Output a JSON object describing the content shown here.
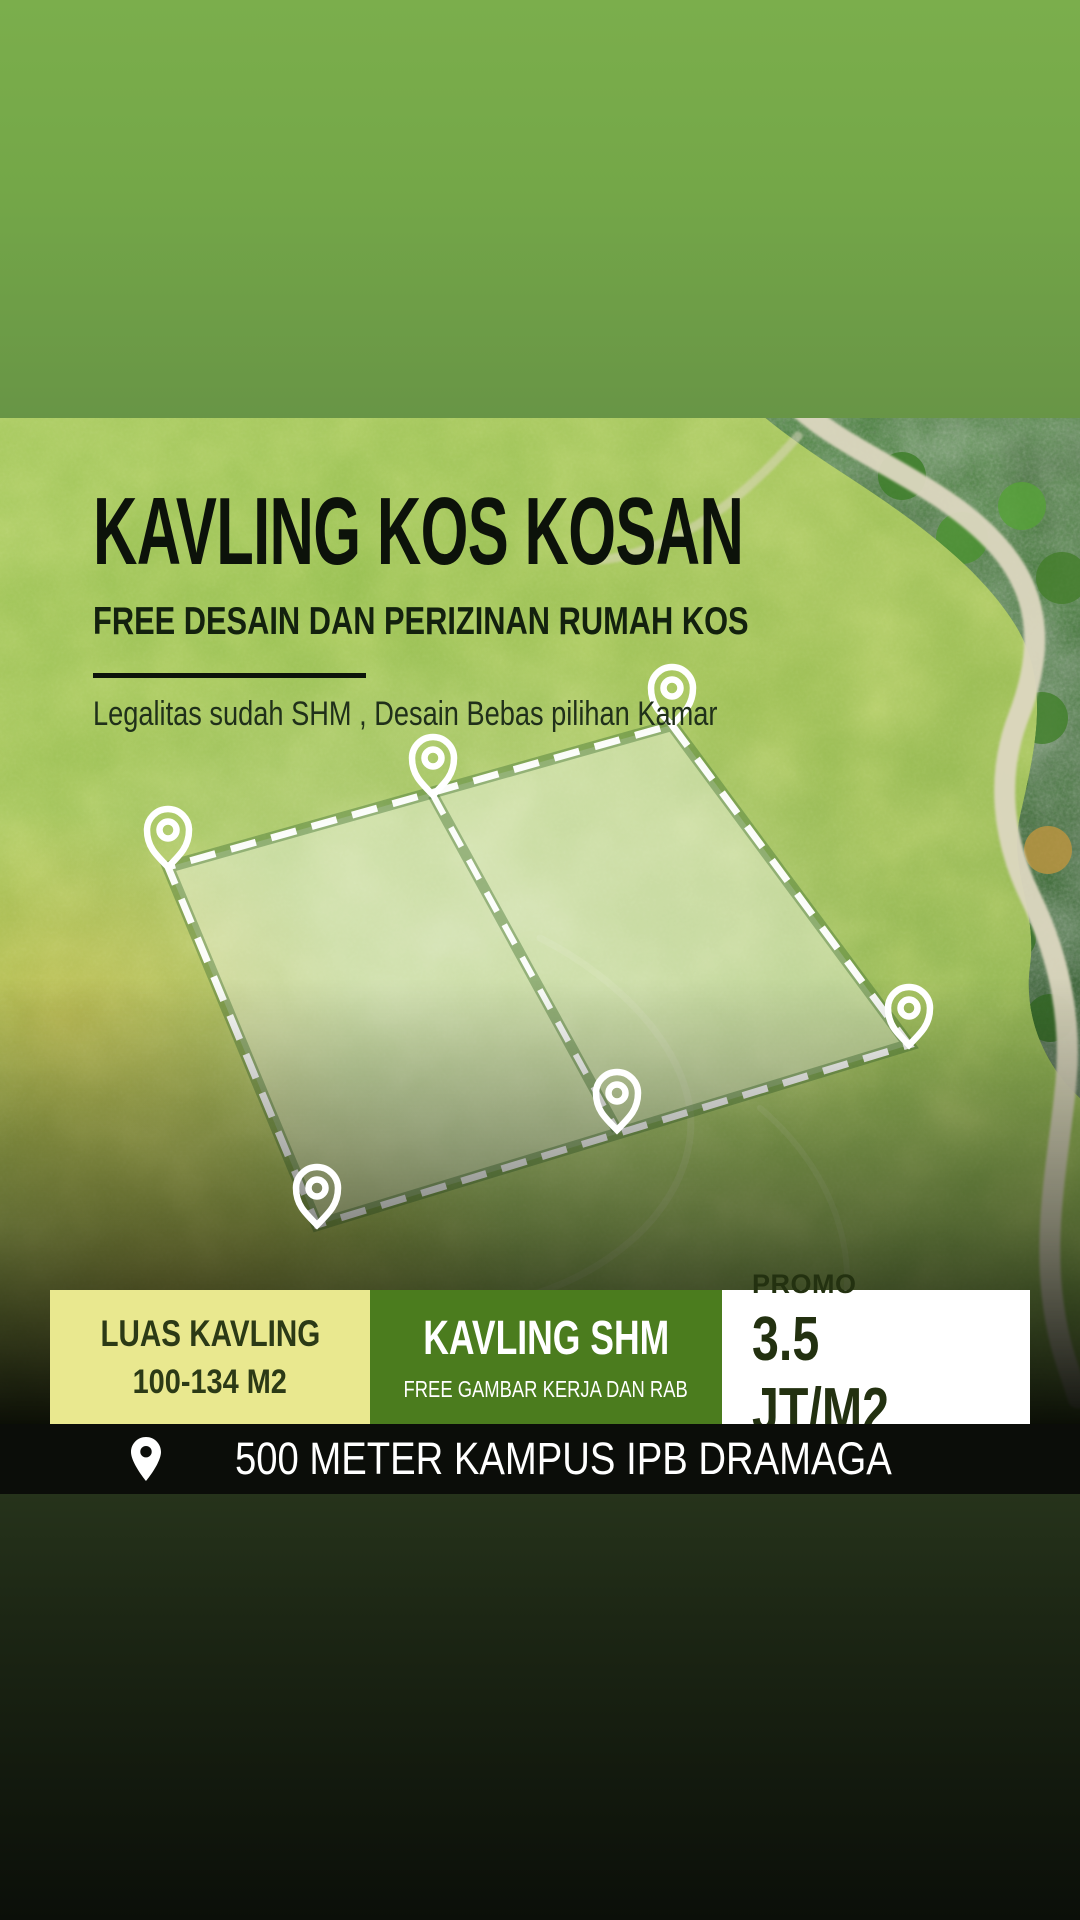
{
  "header": {
    "title": "KAVLING KOS KOSAN",
    "subtitle": "FREE DESAIN DAN PERIZINAN RUMAH KOS",
    "tagline": "Legalitas sudah SHM , Desain Bebas pilihan Kamar"
  },
  "info_boxes": [
    {
      "label": "LUAS KAVLING",
      "value": "100-134 M2",
      "bg": "#e9e88f",
      "fg": "#2c3a16"
    },
    {
      "label": "KAVLING SHM",
      "value": "FREE GAMBAR KERJA DAN RAB",
      "bg": "#4b7c1e",
      "fg": "#ffffff"
    },
    {
      "label": "PROMO",
      "value": "3.5 JT/M2",
      "bg": "#ffffff",
      "fg": "#233110"
    }
  ],
  "location_bar": {
    "text": "500 METER KAMPUS IPB DRAMAGA"
  },
  "icons": {
    "plot_markers": "map-pin-icon",
    "plot_center": "house-icon",
    "location_bar": "location-pin-icon"
  },
  "colors": {
    "top_gradient_start": "#7bae4c",
    "top_gradient_end": "#689546",
    "accent_yellow": "#e9e88f",
    "accent_green": "#4b7c1e",
    "dark_text": "#233110",
    "bar_bg": "#0b0d09",
    "plot_outline": "#ffffff"
  }
}
